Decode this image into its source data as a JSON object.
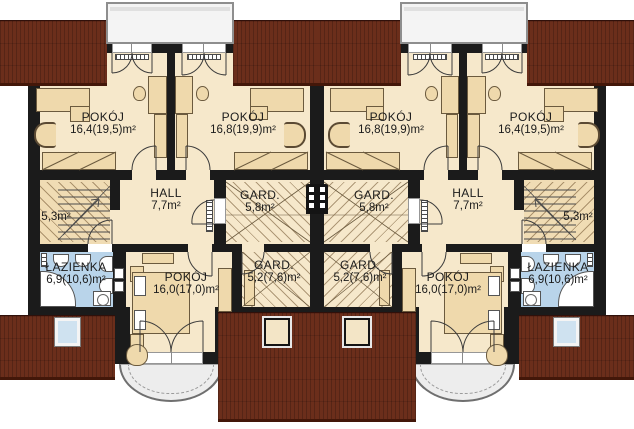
{
  "plan": {
    "kind": "attic floor plan of mirrored duplex",
    "units": {
      "count": 2,
      "arrangement": "mirrored"
    },
    "rooms": {
      "bedroom_front_outer": {
        "name": "POKÓJ",
        "area": "16,4(19,5)m²"
      },
      "bedroom_front_inner": {
        "name": "POKÓJ",
        "area": "16,8(19,9)m²"
      },
      "hall": {
        "name": "HALL",
        "area": "7,7m²"
      },
      "wardrobe_small": {
        "name": "GARD.",
        "area": "5,8m²"
      },
      "wardrobe_large": {
        "name": "GARD.",
        "area": "5,2(7,6)m²"
      },
      "bedroom_back": {
        "name": "POKÓJ",
        "area": "16,0(17,0)m²"
      },
      "bathroom": {
        "name": "ŁAZIENKA",
        "area": "6,9(10,6)m²"
      },
      "attic_nook": {
        "area": "5,3m²"
      }
    },
    "colors": {
      "roof": "#6b2e1b",
      "wall": "#1b1b1b",
      "floor": "#f6e8cb",
      "bathroom_floor": "#b9d4ea",
      "furniture": "#efd9ac",
      "dormer": "#f4f4f4",
      "balcony": "#ededed",
      "skylight_glass": "#cfe2f0"
    }
  }
}
